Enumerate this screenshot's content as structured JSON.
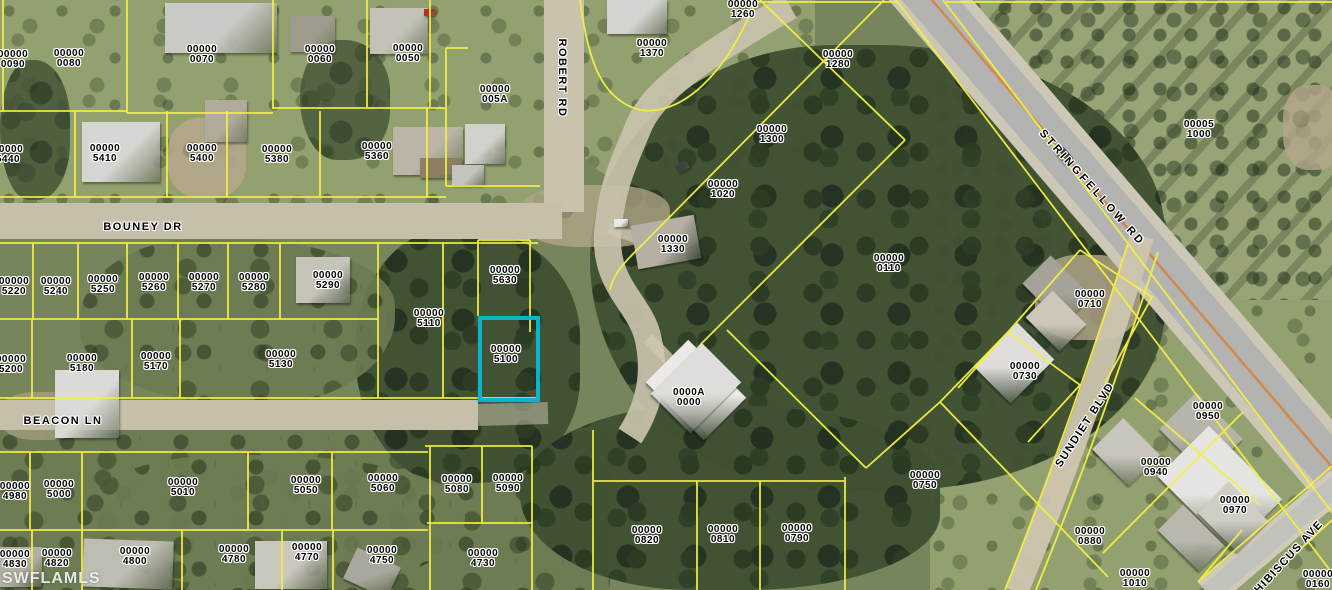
{
  "map": {
    "watermark": "SWFLAMLS",
    "colors": {
      "parcel_line": "#f4f042",
      "highlight": "#0ab5c9",
      "label_text": "#000000",
      "label_halo": "#ffffff",
      "road_major": "#b3b3b1",
      "road_minor": "#c9c2ac",
      "road_centerline": "#d97f35"
    },
    "highlight_parcel": {
      "book": "00000",
      "lot": "5100",
      "x": 478,
      "y": 316,
      "width": 54,
      "height": 78
    }
  },
  "streets": [
    {
      "name": "BOUNEY DR",
      "x": 143,
      "y": 227,
      "rotate": 0
    },
    {
      "name": "ROBERT RD",
      "x": 562,
      "y": 78,
      "rotate": 90
    },
    {
      "name": "BEACON LN",
      "x": 63,
      "y": 421,
      "rotate": 0
    },
    {
      "name": "STRINGFELLOW RD",
      "x": 1092,
      "y": 188,
      "rotate": 48
    },
    {
      "name": "SUNDIET BLVD",
      "x": 1085,
      "y": 425,
      "rotate": -57
    },
    {
      "name": "HIBISCUS AVE",
      "x": 1289,
      "y": 557,
      "rotate": -47
    }
  ],
  "parcels": [
    {
      "book": "00000",
      "lot": "0090",
      "x": 13,
      "y": 60
    },
    {
      "book": "00000",
      "lot": "0080",
      "x": 69,
      "y": 59
    },
    {
      "book": "00000",
      "lot": "0070",
      "x": 202,
      "y": 55
    },
    {
      "book": "00000",
      "lot": "0060",
      "x": 320,
      "y": 55
    },
    {
      "book": "00000",
      "lot": "0050",
      "x": 408,
      "y": 54
    },
    {
      "book": "00000",
      "lot": "5440",
      "x": 8,
      "y": 155
    },
    {
      "book": "00000",
      "lot": "5410",
      "x": 105,
      "y": 154
    },
    {
      "book": "00000",
      "lot": "5400",
      "x": 202,
      "y": 154
    },
    {
      "book": "00000",
      "lot": "5380",
      "x": 277,
      "y": 155
    },
    {
      "book": "00000",
      "lot": "5360",
      "x": 377,
      "y": 152
    },
    {
      "book": "00000",
      "lot": "005A",
      "x": 495,
      "y": 95
    },
    {
      "book": "00000",
      "lot": "5220",
      "x": 14,
      "y": 287
    },
    {
      "book": "00000",
      "lot": "5240",
      "x": 56,
      "y": 287
    },
    {
      "book": "00000",
      "lot": "5250",
      "x": 103,
      "y": 285
    },
    {
      "book": "00000",
      "lot": "5260",
      "x": 154,
      "y": 283
    },
    {
      "book": "00000",
      "lot": "5270",
      "x": 204,
      "y": 283
    },
    {
      "book": "00000",
      "lot": "5280",
      "x": 254,
      "y": 283
    },
    {
      "book": "00000",
      "lot": "5290",
      "x": 328,
      "y": 281
    },
    {
      "book": "00000",
      "lot": "5630",
      "x": 505,
      "y": 276
    },
    {
      "book": "00000",
      "lot": "5110",
      "x": 429,
      "y": 319
    },
    {
      "book": "00000",
      "lot": "5200",
      "x": 11,
      "y": 365
    },
    {
      "book": "00000",
      "lot": "5180",
      "x": 82,
      "y": 364
    },
    {
      "book": "00000",
      "lot": "5170",
      "x": 156,
      "y": 362
    },
    {
      "book": "00000",
      "lot": "5130",
      "x": 281,
      "y": 360
    },
    {
      "book": "00000",
      "lot": "5100",
      "x": 506,
      "y": 355
    },
    {
      "book": "00000",
      "lot": "4980",
      "x": 15,
      "y": 492
    },
    {
      "book": "00000",
      "lot": "5000",
      "x": 59,
      "y": 490
    },
    {
      "book": "00000",
      "lot": "5010",
      "x": 183,
      "y": 488
    },
    {
      "book": "00000",
      "lot": "5050",
      "x": 306,
      "y": 486
    },
    {
      "book": "00000",
      "lot": "5060",
      "x": 383,
      "y": 484
    },
    {
      "book": "00000",
      "lot": "5080",
      "x": 457,
      "y": 485
    },
    {
      "book": "00000",
      "lot": "5090",
      "x": 508,
      "y": 484
    },
    {
      "book": "00000",
      "lot": "4830",
      "x": 15,
      "y": 560
    },
    {
      "book": "00000",
      "lot": "4820",
      "x": 57,
      "y": 559
    },
    {
      "book": "00000",
      "lot": "4800",
      "x": 135,
      "y": 557
    },
    {
      "book": "00000",
      "lot": "4780",
      "x": 234,
      "y": 555
    },
    {
      "book": "00000",
      "lot": "4770",
      "x": 307,
      "y": 553
    },
    {
      "book": "00000",
      "lot": "4750",
      "x": 382,
      "y": 556
    },
    {
      "book": "00000",
      "lot": "4730",
      "x": 483,
      "y": 559
    },
    {
      "book": "00000",
      "lot": "1370",
      "x": 652,
      "y": 49
    },
    {
      "book": "00000",
      "lot": "1260",
      "x": 743,
      "y": 10
    },
    {
      "book": "00000",
      "lot": "1280",
      "x": 838,
      "y": 60
    },
    {
      "book": "00000",
      "lot": "1300",
      "x": 772,
      "y": 135
    },
    {
      "book": "00000",
      "lot": "1020",
      "x": 723,
      "y": 190
    },
    {
      "book": "00000",
      "lot": "1330",
      "x": 673,
      "y": 245
    },
    {
      "book": "00000",
      "lot": "0110",
      "x": 889,
      "y": 264
    },
    {
      "book": "00005",
      "lot": "1000",
      "x": 1199,
      "y": 130
    },
    {
      "book": "00000",
      "lot": "0710",
      "x": 1090,
      "y": 300
    },
    {
      "book": "00000",
      "lot": "0730",
      "x": 1025,
      "y": 372
    },
    {
      "book": "00000",
      "lot": "0750",
      "x": 925,
      "y": 481
    },
    {
      "book": "00000",
      "lot": "0950",
      "x": 1208,
      "y": 412
    },
    {
      "book": "00000",
      "lot": "0940",
      "x": 1156,
      "y": 468
    },
    {
      "book": "00000",
      "lot": "0970",
      "x": 1235,
      "y": 506
    },
    {
      "book": "00000",
      "lot": "0880",
      "x": 1090,
      "y": 537
    },
    {
      "book": "00000",
      "lot": "0820",
      "x": 647,
      "y": 536
    },
    {
      "book": "00000",
      "lot": "0810",
      "x": 723,
      "y": 535
    },
    {
      "book": "00000",
      "lot": "0790",
      "x": 797,
      "y": 534
    },
    {
      "book": "0000A",
      "lot": "0000",
      "x": 689,
      "y": 398
    },
    {
      "book": "00000",
      "lot": "1010",
      "x": 1135,
      "y": 579
    },
    {
      "book": "00000",
      "lot": "0160",
      "x": 1318,
      "y": 580
    }
  ]
}
